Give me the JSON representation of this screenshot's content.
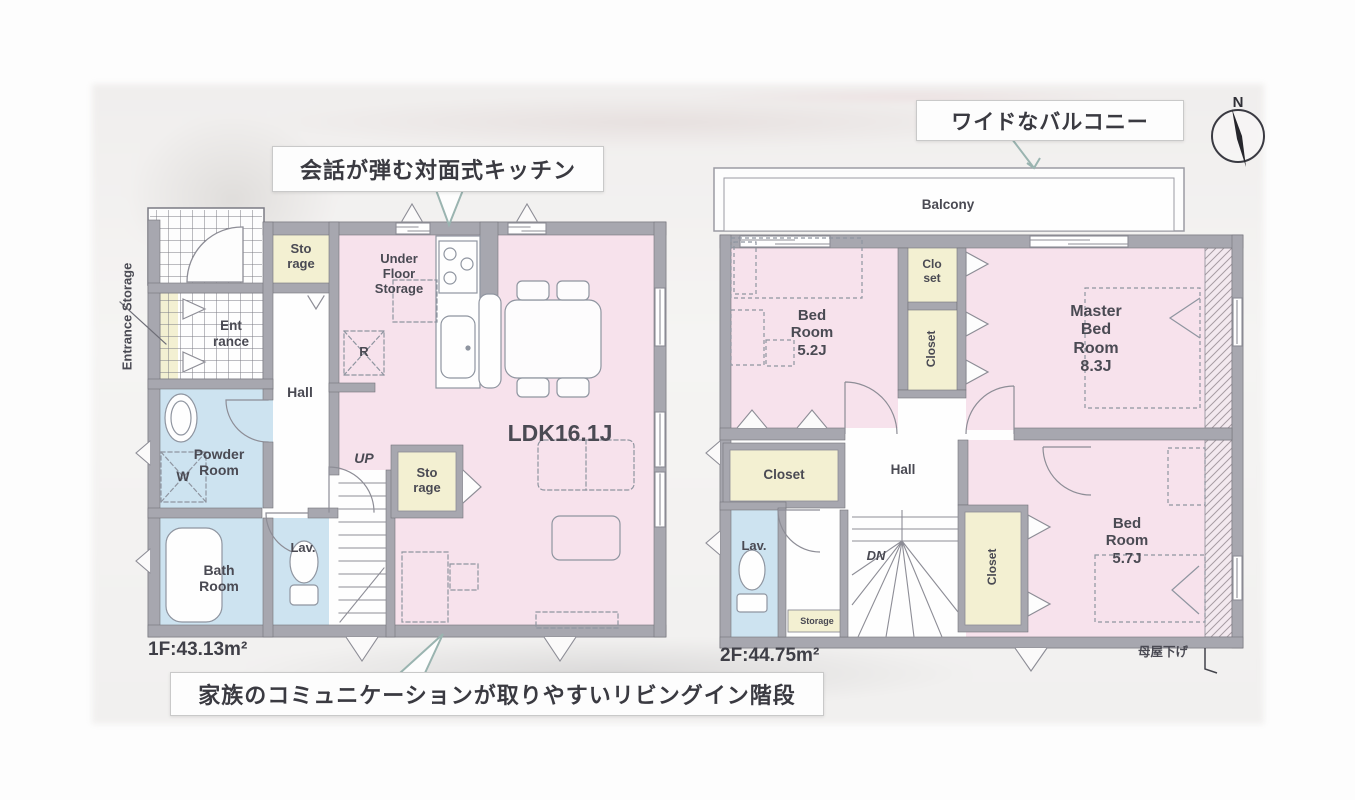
{
  "callouts": {
    "kitchen": "会話が弾む対面式キッチン",
    "balcony": "ワイドなバルコニー",
    "stairs": "家族のコミュニケーションが取りやすいリビングイン階段"
  },
  "compass": {
    "north": "N"
  },
  "floor1": {
    "area": "1F:43.13m²",
    "entrance_storage": "Entrance Storage",
    "storage_top": "Sto\nrage",
    "under_floor_storage": "Under\nFloor\nStorage",
    "entrance": "Ent\nrance",
    "hall": "Hall",
    "refrigerator": "R",
    "powder_room": "Powder\nRoom",
    "washer": "W",
    "up": "UP",
    "storage_mid": "Sto\nrage",
    "ldk": "LDK16.1J",
    "bath_room": "Bath\nRoom",
    "lavatory": "Lav."
  },
  "floor2": {
    "area": "2F:44.75m²",
    "balcony": "Balcony",
    "bedroom1": "Bed\nRoom\n5.2J",
    "closet_upper": "Clo\nset",
    "closet_mid": "Closet",
    "master_bedroom": "Master\nBed\nRoom\n8.3J",
    "closet_left": "Closet",
    "hall": "Hall",
    "lavatory": "Lav.",
    "storage_small": "Storage",
    "down": "DN",
    "closet_lower": "Closet",
    "bedroom2": "Bed\nRoom\n5.7J",
    "moya_sage": "母屋下げ"
  },
  "colors": {
    "room_pink": "#f7e2ec",
    "room_blue": "#cde3f0",
    "room_yellow": "#f3f0d2",
    "wall_gray": "#a7a7af",
    "pointer_teal": "#9ab4b0",
    "label_gray": "#4a4a53"
  }
}
